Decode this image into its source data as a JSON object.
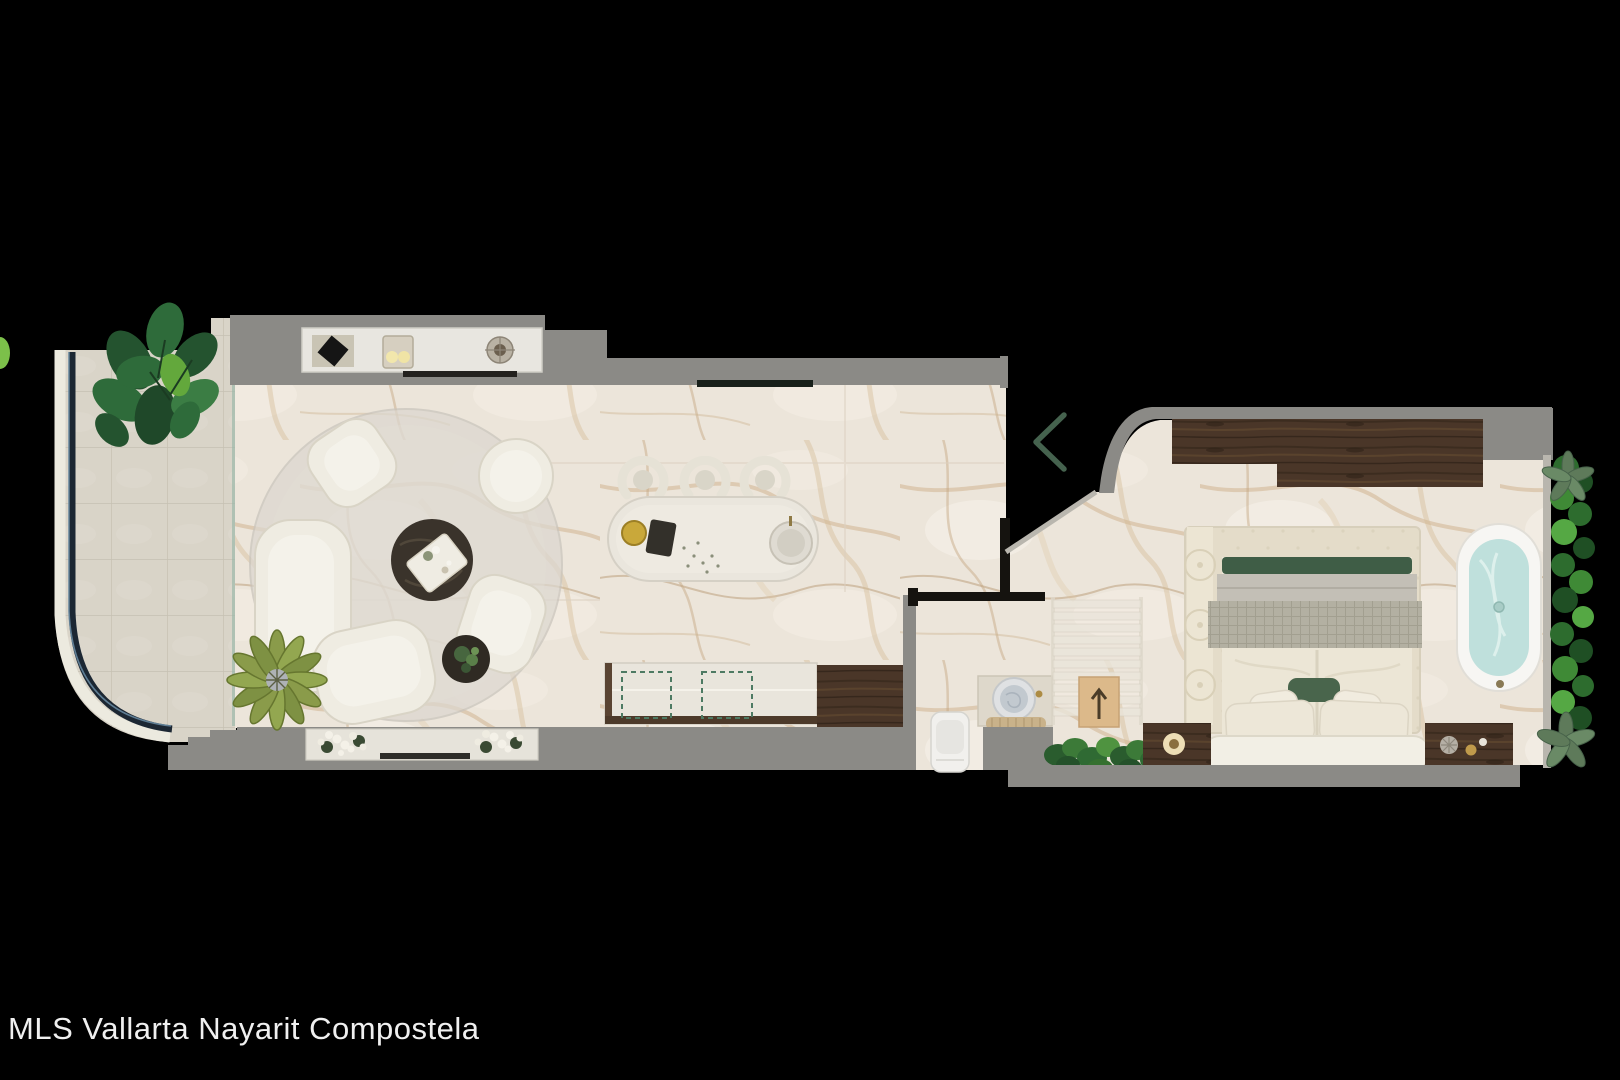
{
  "page": {
    "watermark": "MLS Vallarta Nayarit Compostela"
  },
  "viewer": {
    "prev_icon": "chevron-left"
  },
  "colors": {
    "background": "#000000",
    "wall_gray": "#8b8a86",
    "marble_base": "#ece5da",
    "terrace_tile": "#d9d4c8",
    "wood_dark": "#4a3628",
    "accent_green": "#45624e",
    "tub_water": "#bfe0dc",
    "plant_green": "#2e6b2f",
    "railing_navy": "#1c2733",
    "watermark_white": "#f0f0f0"
  }
}
